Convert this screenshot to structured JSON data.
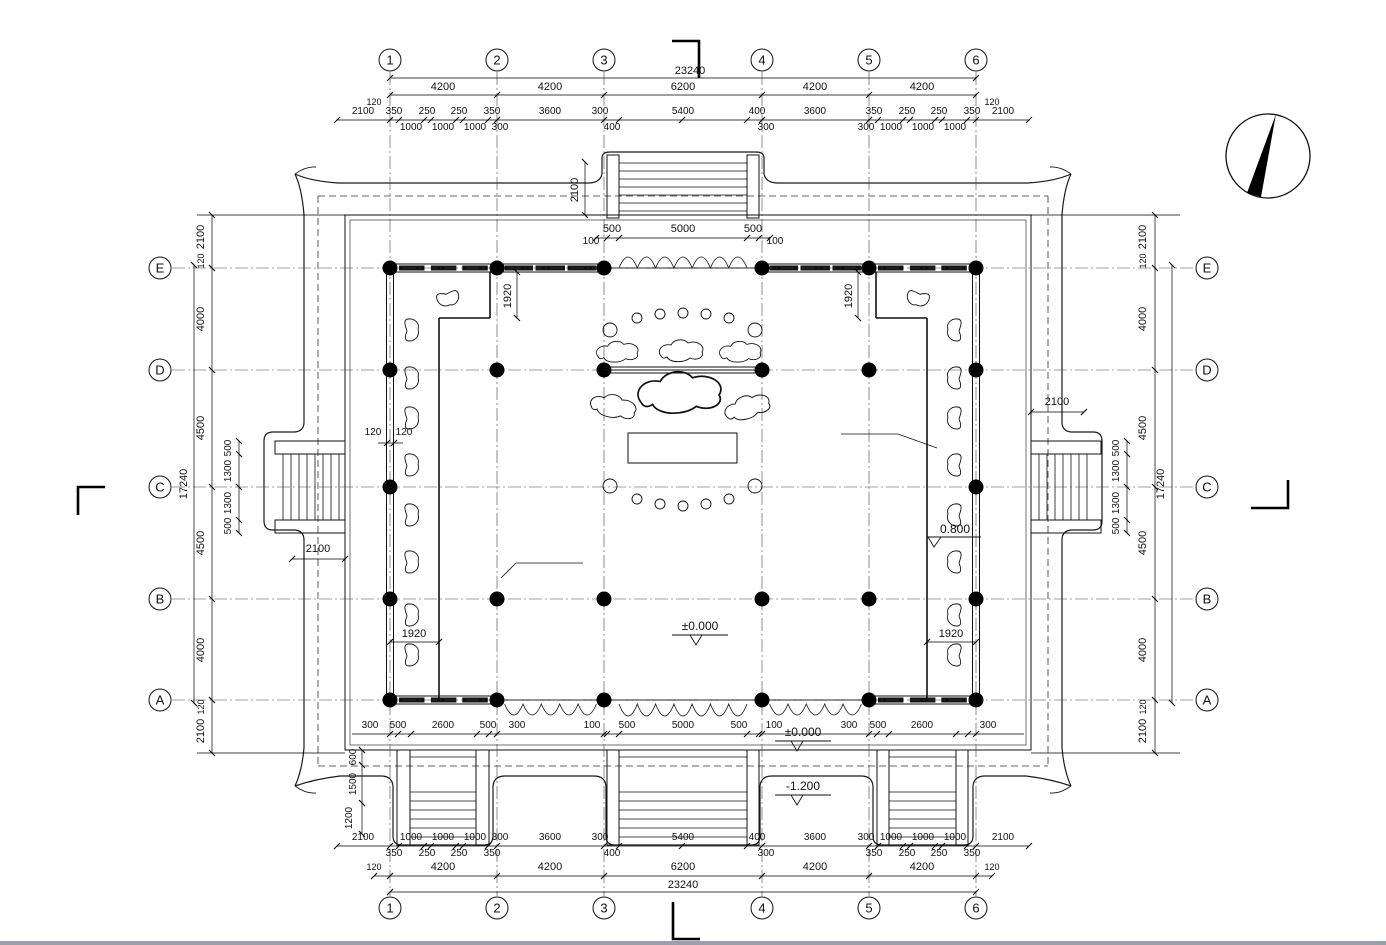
{
  "drawing": {
    "type_label": "temple-floor-plan",
    "icons": {
      "north_arrow": "compass-needle-icon",
      "section_mark": "section-cut-icon",
      "level_mark": "elevation-level-icon"
    }
  },
  "grid": {
    "cols": [
      "1",
      "2",
      "3",
      "4",
      "5",
      "6"
    ],
    "rows": [
      "E",
      "D",
      "C",
      "B",
      "A"
    ]
  },
  "dims": {
    "top": {
      "overall": "23240",
      "main": [
        "4200",
        "4200",
        "6200",
        "4200",
        "4200"
      ],
      "edge": [
        "120",
        "120"
      ],
      "upper": [
        "2100",
        "350",
        "250",
        "250",
        "350",
        "3600",
        "300",
        "5400",
        "400",
        "3600",
        "350",
        "250",
        "250",
        "350",
        "2100"
      ],
      "lower": [
        "1000",
        "1000",
        "1000",
        "300",
        "400",
        "300",
        "300",
        "1000",
        "1000",
        "1000"
      ],
      "stair_len": "2100",
      "stair": [
        "500",
        "5000",
        "500"
      ],
      "gap": [
        "100",
        "100"
      ]
    },
    "bottom": {
      "wall": [
        "300",
        "500",
        "2600",
        "500",
        "300",
        "100",
        "500",
        "5000",
        "500",
        "100",
        "300",
        "500",
        "2600",
        "300"
      ],
      "upper": [
        "2100",
        "1000",
        "1000",
        "1000",
        "300",
        "3600",
        "300",
        "5400",
        "400",
        "3600",
        "300",
        "1000",
        "1000",
        "1000",
        "2100"
      ],
      "lower": [
        "350",
        "250",
        "250",
        "350",
        "400",
        "300",
        "350",
        "250",
        "250",
        "350"
      ],
      "main": [
        "120",
        "4200",
        "4200",
        "6200",
        "4200",
        "4200",
        "120"
      ],
      "overall": "23240",
      "steps": [
        "600",
        "1500",
        "1200"
      ]
    },
    "left": {
      "top": [
        "2100",
        "120"
      ],
      "main": [
        "4000",
        "4500",
        "4500",
        "4000"
      ],
      "overall": "17240",
      "inner": [
        "500",
        "1300",
        "1300",
        "500"
      ],
      "bottom": [
        "120",
        "2100"
      ],
      "stair": "2100"
    },
    "right": {
      "top": [
        "2100",
        "120"
      ],
      "main": [
        "4000",
        "4500",
        "4500",
        "4000"
      ],
      "overall": "17240",
      "inner": [
        "500",
        "1300",
        "1300",
        "500"
      ],
      "bottom": [
        "120",
        "2100"
      ],
      "stair": "2100"
    },
    "inner": {
      "w1920": [
        "1920",
        "1920",
        "1920",
        "1920"
      ],
      "w120": [
        "120",
        "120"
      ]
    },
    "levels": {
      "zero_floor": "±0.000",
      "zero_terrace": "±0.000",
      "minus12": "-1.200",
      "p08": "0.800"
    }
  }
}
